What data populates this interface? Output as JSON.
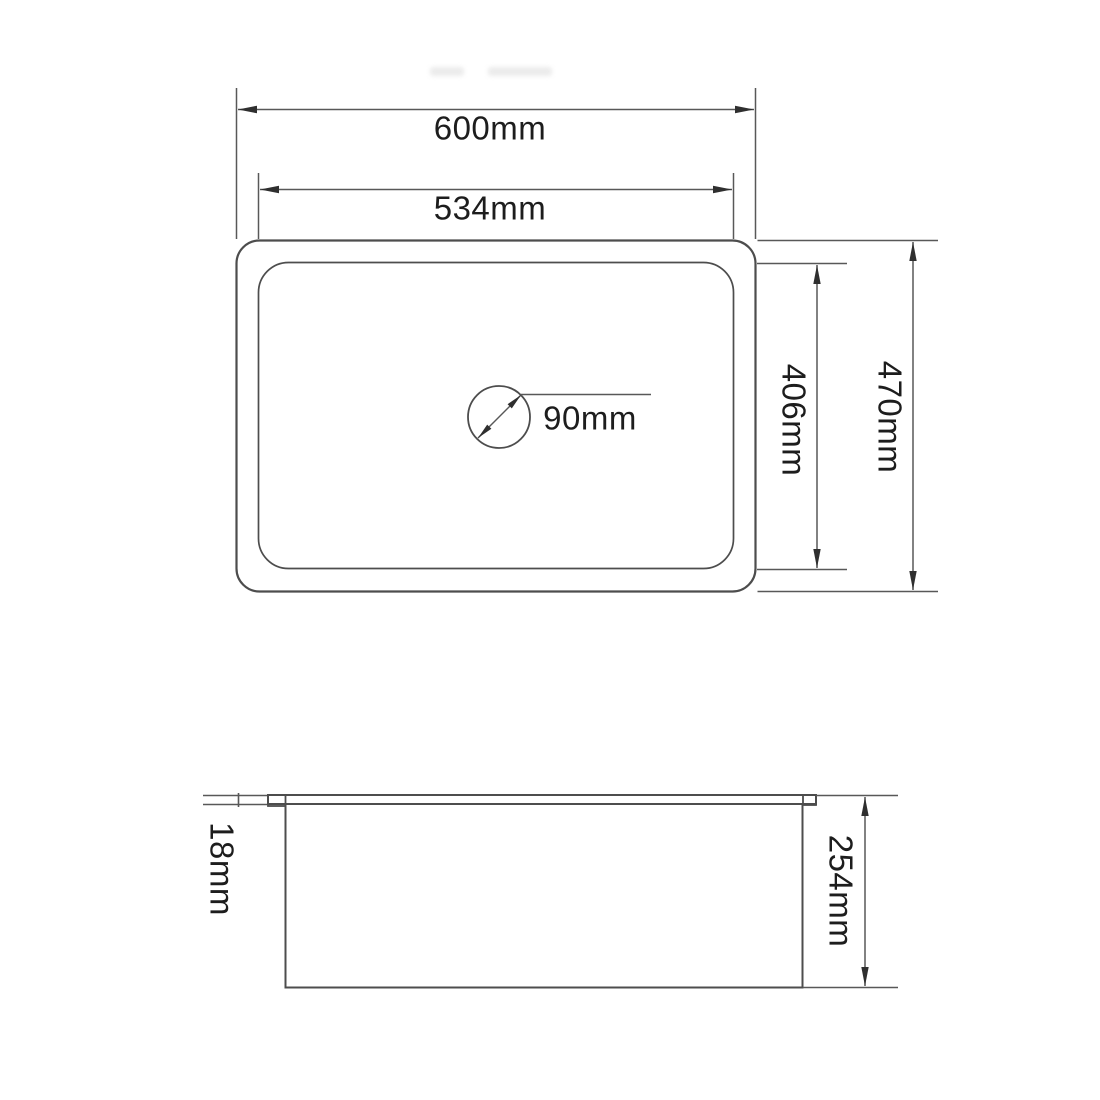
{
  "page": {
    "background": "#ffffff",
    "line_color": "#4d4d4d",
    "text_color": "#1d1d1d"
  },
  "top_view": {
    "outer_width_label": "600mm",
    "inner_width_label": "534mm",
    "outer_height_label": "470mm",
    "inner_height_label": "406mm",
    "drain_diameter_label": "90mm"
  },
  "side_view": {
    "rim_thickness_label": "18mm",
    "bowl_depth_label": "254mm"
  }
}
